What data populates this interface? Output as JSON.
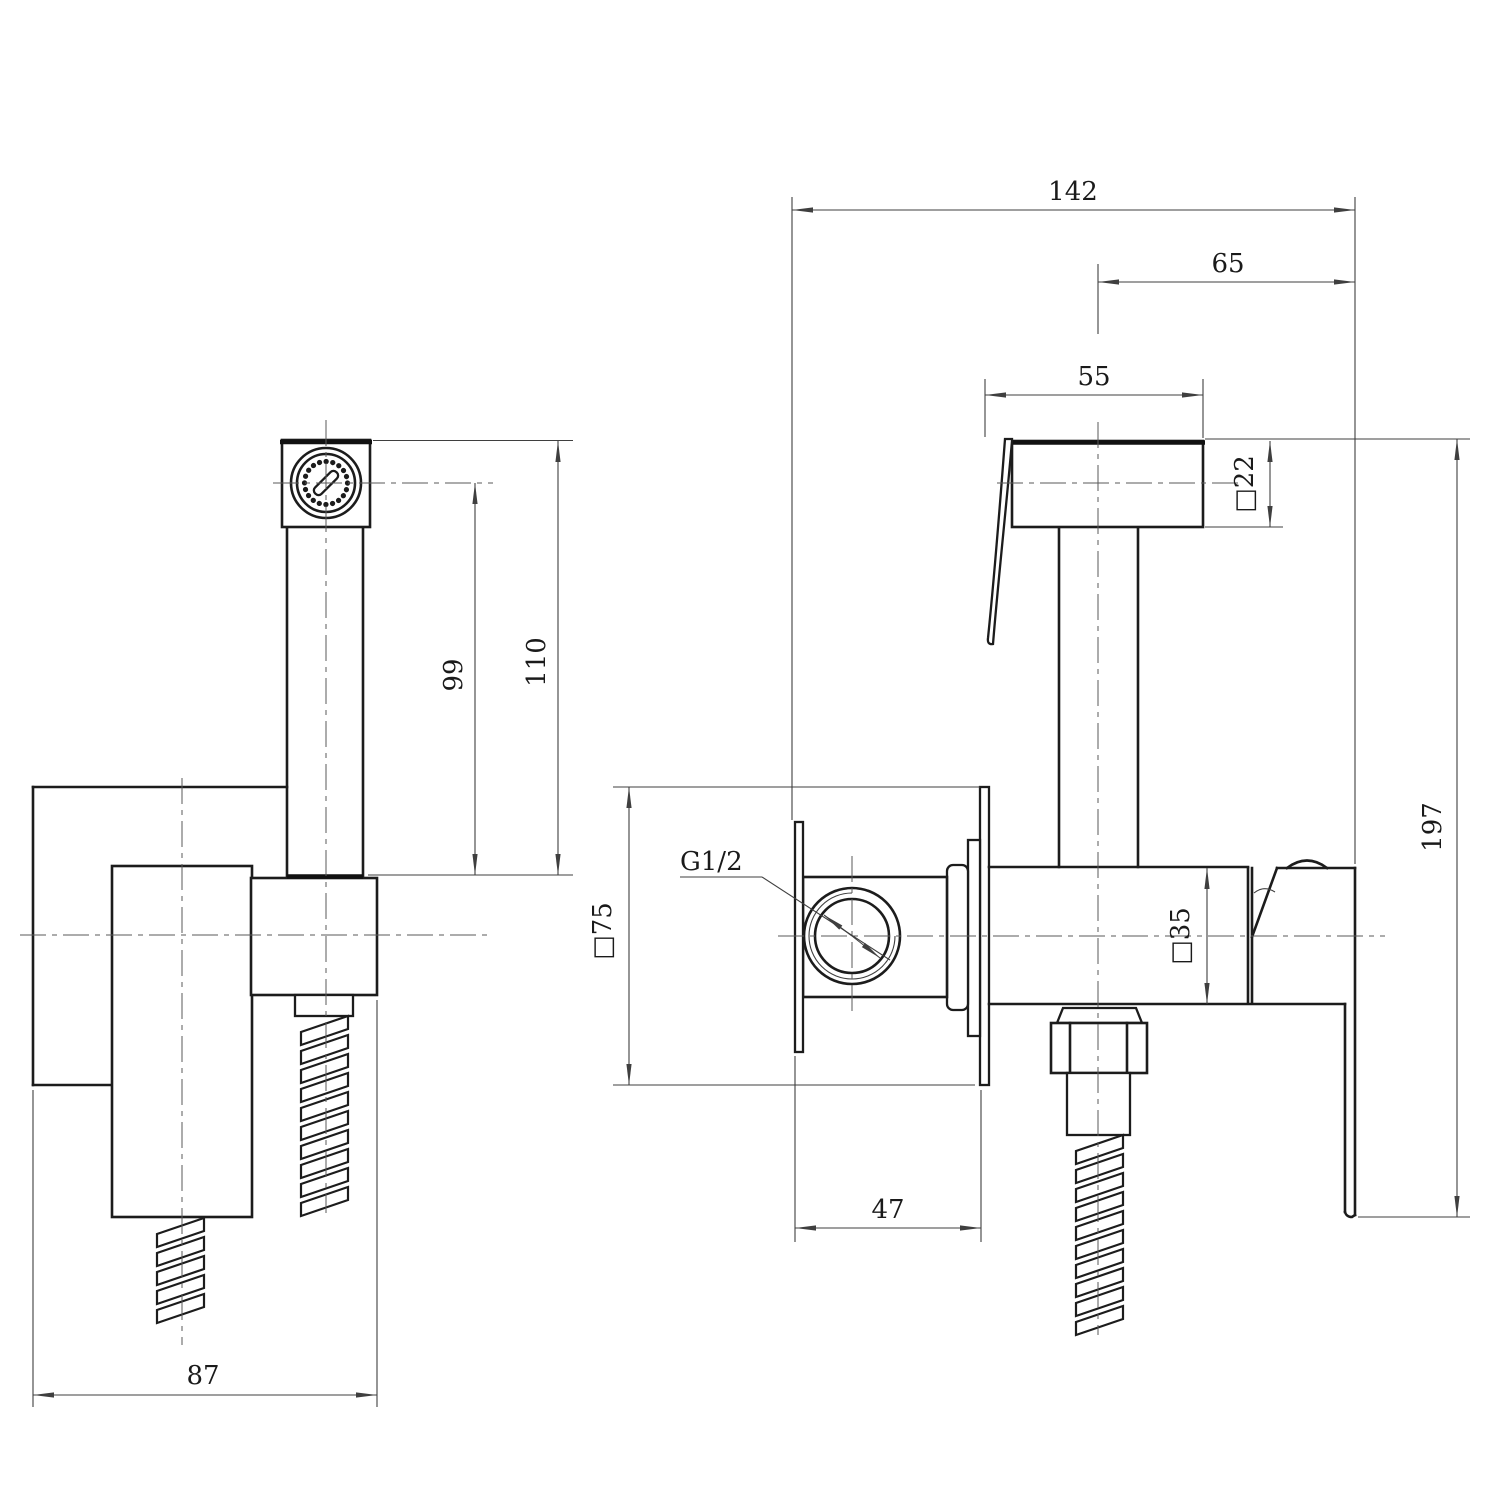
{
  "drawing": {
    "kind": "technical-drawing",
    "views": {
      "left": "front view",
      "right": "side view"
    },
    "colors": {
      "line": "#1c1c1c",
      "dim": "#3f3f3f",
      "background": "#ffffff"
    }
  },
  "dimensions": {
    "overall_width": "142",
    "handle_offset": "65",
    "head_length": "55",
    "head_square": "□22",
    "hose_clearance": "110",
    "head_center_height": "99",
    "overall_height": "197",
    "plate_square": "□75",
    "inlet_thread": "G1/2",
    "body_square": "□35",
    "plate_depth": "47",
    "front_width": "87"
  }
}
